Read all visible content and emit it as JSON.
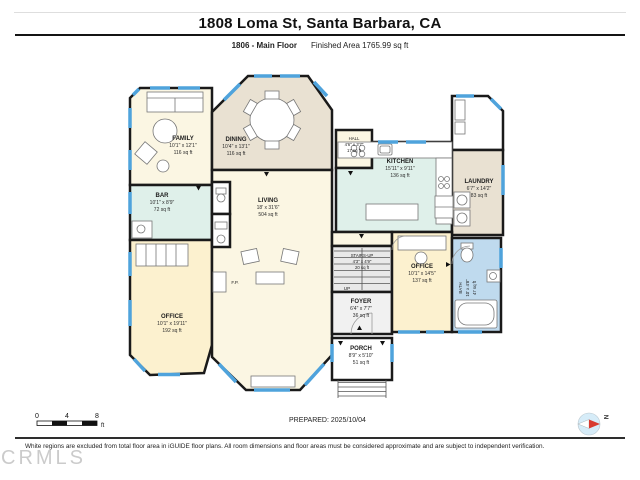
{
  "header": {
    "title": "1808 Loma St, Santa Barbara, CA",
    "floor_label": "1806 - Main Floor",
    "finished_area": "Finished Area 1765.99 sq ft"
  },
  "rooms": {
    "family": {
      "name": "FAMILY",
      "dims": "10'1\" x 12'1\"",
      "area": "116 sq ft"
    },
    "dining": {
      "name": "DINING",
      "dims": "10'4\" x 13'1\"",
      "area": "116 sq ft"
    },
    "bar": {
      "name": "BAR",
      "dims": "10'1\" x 8'9\"",
      "area": "72 sq ft"
    },
    "living": {
      "name": "LIVING",
      "dims": "18' x 31'6\"",
      "area": "504 sq ft"
    },
    "hall": {
      "name": "HALL",
      "dims": "4'6\" x 3'7\"",
      "area": "17 sq ft"
    },
    "kitchen": {
      "name": "KITCHEN",
      "dims": "15'11\" x 9'11\"",
      "area": "136 sq ft"
    },
    "laundry": {
      "name": "LAUNDRY",
      "dims": "6'7\" x 14'2\"",
      "area": "83 sq ft"
    },
    "stairs": {
      "name": "STAIRS-UP",
      "dims": "4'3\" x 4'9\"",
      "area": "20 sq ft"
    },
    "foyer": {
      "name": "FOYER",
      "dims": "6'4\" x 7'7\"",
      "area": "36 sq ft"
    },
    "office_left": {
      "name": "OFFICE",
      "dims": "10'1\" x 19'11\"",
      "area": "192 sq ft"
    },
    "office_right": {
      "name": "OFFICE",
      "dims": "10'1\" x 14'5\"",
      "area": "137 sq ft"
    },
    "bath": {
      "name": "BATH",
      "dims": "10' x 4'8\"",
      "area": "47 sq ft"
    },
    "porch": {
      "name": "PORCH",
      "dims": "8'9\" x 5'10\"",
      "area": "51 sq ft"
    },
    "up_label": "UP",
    "fireplace_label": "F.P."
  },
  "scale": {
    "t0": "0",
    "t4": "4",
    "t8": "8",
    "unit": "ft"
  },
  "compass": {
    "north": "N"
  },
  "footer": {
    "prepared": "PREPARED: 2025/10/04",
    "disclaimer": "White regions are excluded from total floor area in iGUIDE floor plans. All room dimensions and floor areas must be considered approximate and are subject to independent verification.",
    "watermark": "CRMLS"
  },
  "colors": {
    "wall": "#1a1a1a",
    "window": "#4FA3DC",
    "cream": "#FBF6E3",
    "beige": "#E9E1D2",
    "mint": "#DFF0EA",
    "yellow": "#FCF1CF",
    "bath_blue": "#BFDAEE",
    "gray": "#EBEBEB"
  }
}
